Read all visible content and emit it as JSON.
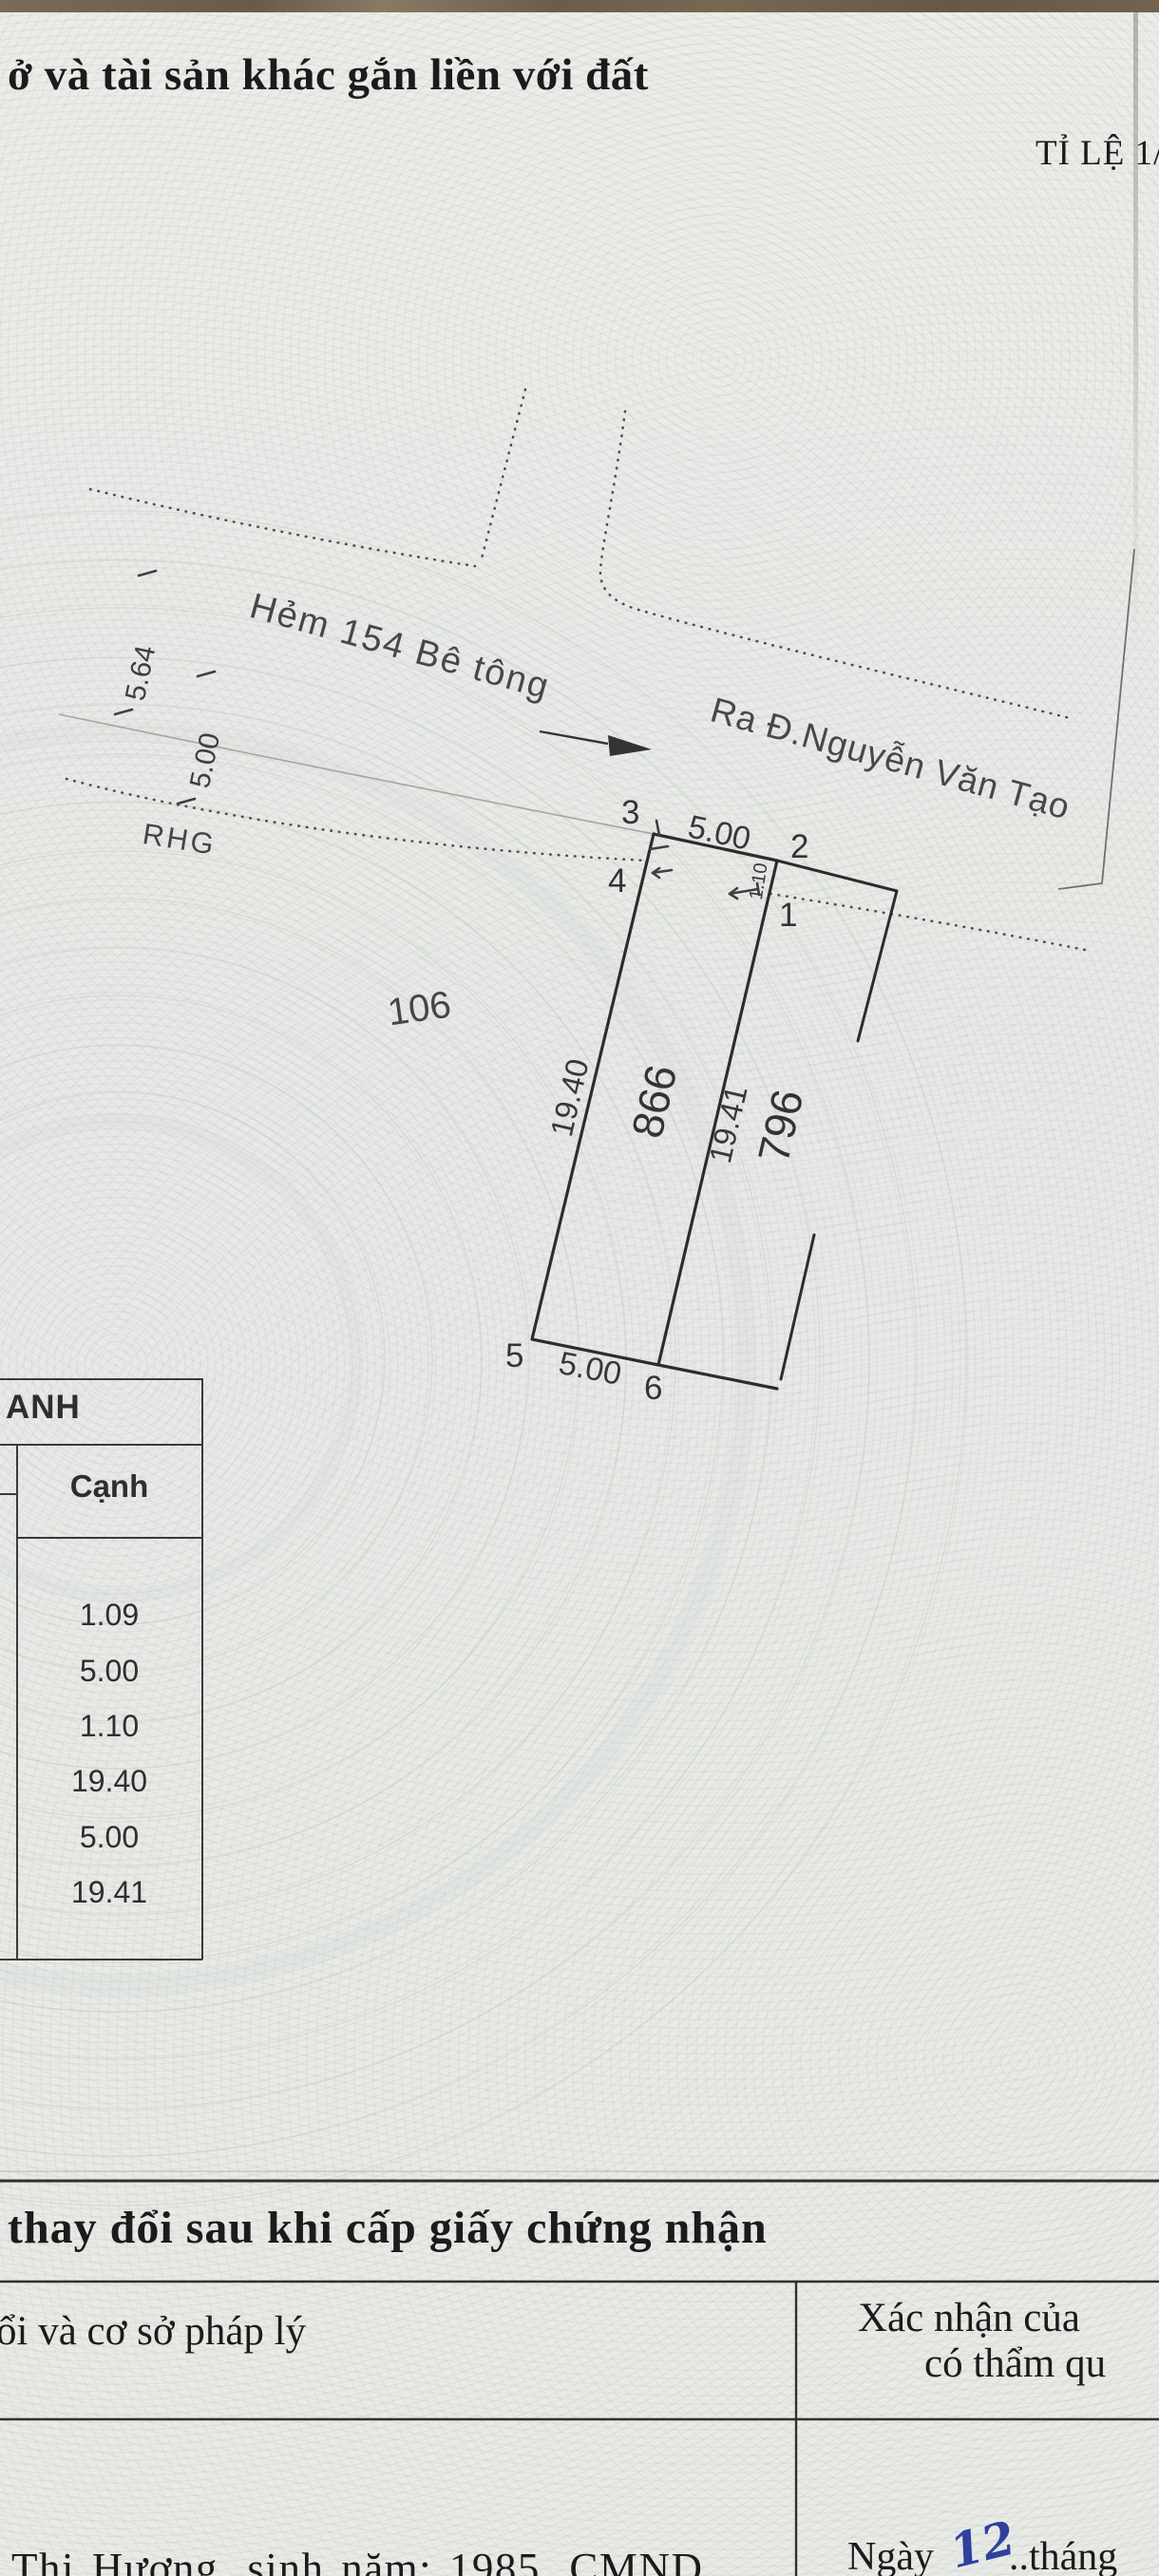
{
  "header": {
    "title_fragment": "ở và tài sản khác gắn liền với đất",
    "scale_label": "TỈ LỆ 1/"
  },
  "map": {
    "alley_label": "Hẻm 154 Bê tông",
    "direction_label": "Ra Đ.Nguyễn Văn Tạo",
    "boundary_code": "RHG",
    "road_width_a": "5.64",
    "road_width_b": "5.00",
    "adjacent_parcel_number": "106",
    "parcel_number_left": "866",
    "parcel_number_right": "796",
    "frontage_top": "5.00",
    "frontage_bottom": "5.00",
    "depth_left": "19.40",
    "depth_middle": "19.41",
    "setback_dim": "1.10",
    "point_labels": [
      "1",
      "2",
      "3",
      "4",
      "5",
      "6"
    ]
  },
  "edge_table": {
    "header_fragment": "ANH",
    "column_header": "Cạnh",
    "values": [
      "1.09",
      "5.00",
      "1.10",
      "19.40",
      "5.00",
      "19.41"
    ]
  },
  "changes_section": {
    "heading_fragment": "thay đổi sau khi cấp giấy chứng nhận",
    "left_column_fragment": "ổi và cơ sở pháp lý",
    "right_column_line1": "Xác nhận của",
    "right_column_line2": "có thẩm qu",
    "entry_left_fragment": "Thị Hương, sinh năm: 1985, CMND",
    "entry_right_prefix": "Ngày",
    "entry_right_day": "12",
    "entry_right_suffix": "..tháng"
  },
  "colors": {
    "ink": "#2c2c2c",
    "handwriting_blue": "#30409d",
    "paper": "#e9ebe7",
    "top_bar": "#6e5c49"
  }
}
